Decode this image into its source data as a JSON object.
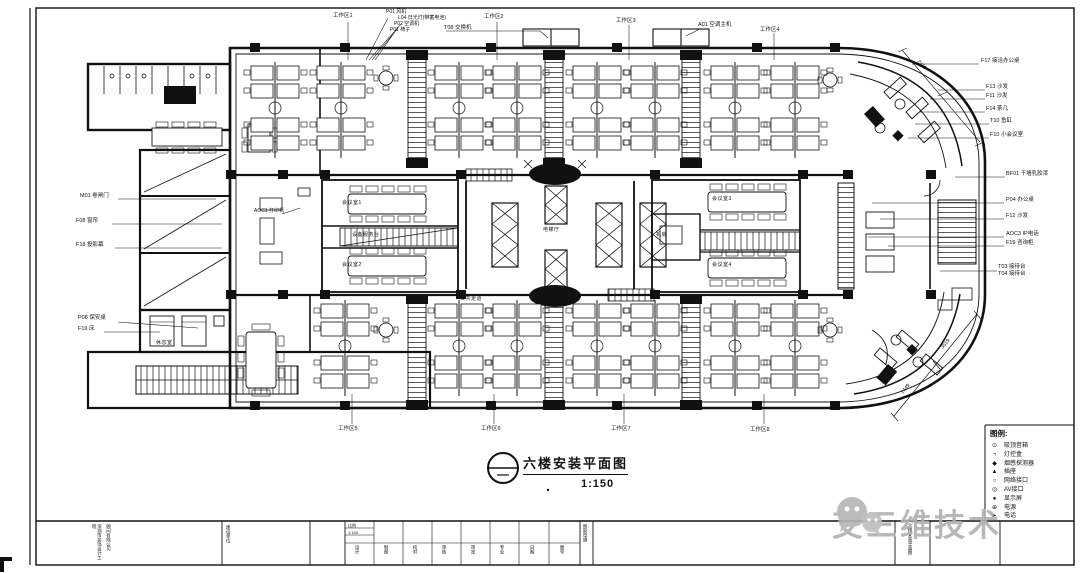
{
  "title": {
    "name": "六楼安装平面图",
    "scale": "1:150"
  },
  "watermark": {
    "text": "艾三维技术"
  },
  "callouts": {
    "top": [
      "工作区1",
      "P01 风机",
      "L04 日光灯(带蓄电池)",
      "P02 空调机",
      "P01 椅子",
      "T08 交换机",
      "工作区2",
      "工作区3",
      "A01 空调主机",
      "工作区4"
    ],
    "right": [
      "F17 接洽办公桌",
      "F13 沙发",
      "F11 沙发",
      "F14 茶几",
      "T10 鱼缸",
      "F10 小会议室",
      "BF01 干墙乳胶漆",
      "P04 办公桌",
      "F12 沙发",
      "AOC3 IP电话",
      "F19 咨询柜",
      "T03 接待台",
      "T04 接待台"
    ],
    "left": [
      "M01 卷闸门",
      "F08 窗帘",
      "F18 投影幕",
      "P08 保安桌",
      "F19 床"
    ],
    "bottom": [
      "工作区5",
      "工作区6",
      "工作区7",
      "工作区8"
    ],
    "inner": [
      "AOC1 打印机"
    ]
  },
  "rooms": [
    "会议室1",
    "会议室2",
    "电梯厅",
    "会议室3",
    "会议室4",
    "机房",
    "休息室",
    "设备服务台",
    "公共走道"
  ],
  "dimensions": [
    "2449",
    "2449",
    "3519"
  ],
  "legend": {
    "title": "图例:",
    "items": [
      {
        "sym": "⊙",
        "label": "吸顶音箱"
      },
      {
        "sym": "¬",
        "label": "灯控盒"
      },
      {
        "sym": "◆",
        "label": "烟感探测器"
      },
      {
        "sym": "▲",
        "label": "插座"
      },
      {
        "sym": "○",
        "label": "网络接口"
      },
      {
        "sym": "◎",
        "label": "AV接口"
      },
      {
        "sym": "●",
        "label": "显示屏"
      },
      {
        "sym": "⊕",
        "label": "电源"
      },
      {
        "sym": "►",
        "label": "电话"
      }
    ]
  },
  "titleblock": {
    "company_line1": "深圳市装饰设计工程",
    "company_line2": "顾问有限公司",
    "owner": "建设单位",
    "scale_label": "比例",
    "scale_value": "1:150",
    "signoff": [
      "设计",
      "制图",
      "校对",
      "审核",
      "审定",
      "专业",
      "日期",
      "图号"
    ],
    "sheet_class": "图别电施",
    "drawing_name": "六楼安装平面图"
  }
}
